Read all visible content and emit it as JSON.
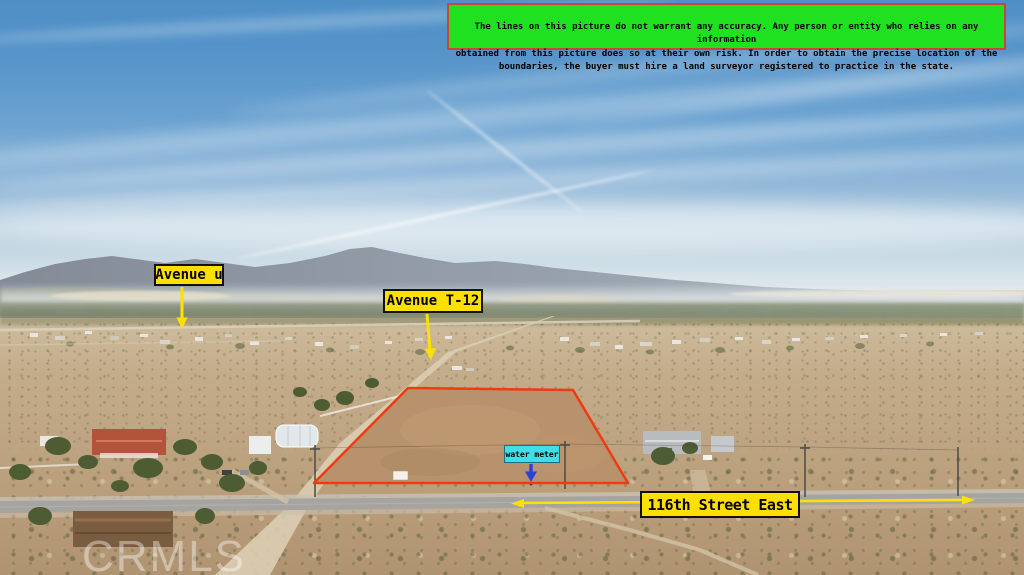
{
  "disclaimer": {
    "lines": "The lines on this picture do not warrant any accuracy. Any person or entity who relies on any information\nobtained from this picture does so at their own risk. In order to obtain the precise location of the\nboundaries, the buyer must hire a land surveyor registered to practice in the state."
  },
  "labels": {
    "avenue_u": "Avenue u",
    "avenue_t12": "Avenue T-12",
    "street_116": "116th Street East",
    "water_meter": "water meter"
  },
  "watermark": {
    "text": "CRMLS"
  },
  "colors": {
    "label_bg": "#ffdf00",
    "label_border": "#111111",
    "label_text": "#000000",
    "arrow": "#ffe000",
    "boundary": "#ee3b12",
    "water_label_bg": "#41dde8",
    "water_arrow": "#2b43d6",
    "disclaimer_bg": "#20e120",
    "disclaimer_border": "#cc4433",
    "watermark": "rgba(255,255,255,0.40)"
  }
}
